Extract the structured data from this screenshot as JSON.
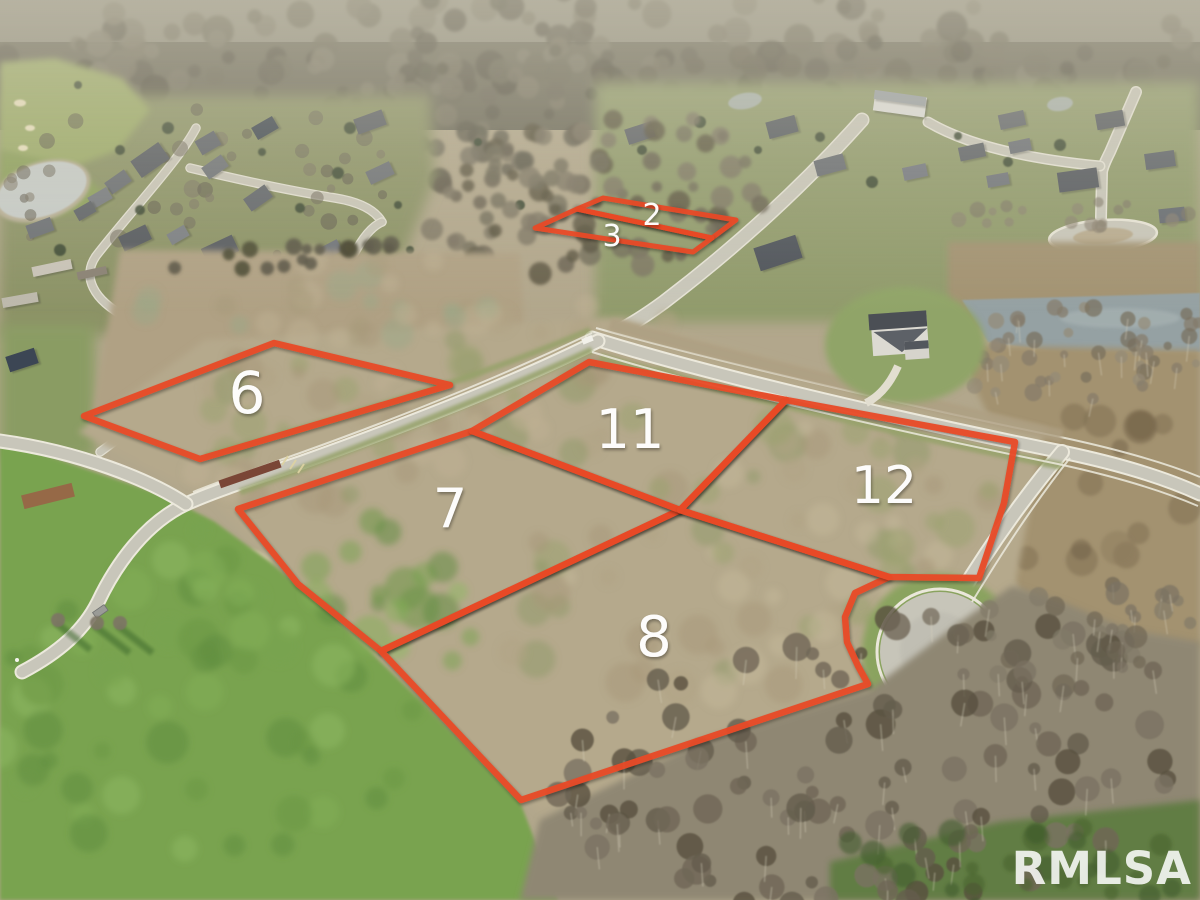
{
  "photo": {
    "description": "Aerial drone photo of a residential subdivision with vacant lots outlined",
    "width": 1200,
    "height": 900
  },
  "annotations": {
    "line_color": "#e84a28",
    "label_color": "#ffffff",
    "lots": [
      {
        "id": "2",
        "label": "2",
        "label_x": 652,
        "label_y": 225,
        "font_size": 30,
        "points": "577,209 603,198 736,220 712,238"
      },
      {
        "id": "3",
        "label": "3",
        "label_x": 612,
        "label_y": 246,
        "font_size": 30,
        "points": "535,228 577,209 712,238 693,252"
      },
      {
        "id": "6",
        "label": "6",
        "label_x": 247,
        "label_y": 413,
        "font_size": 58,
        "points": "84,416 274,343 450,385 200,459"
      },
      {
        "id": "7",
        "label": "7",
        "label_x": 450,
        "label_y": 527,
        "font_size": 54,
        "points": "472,431 680,510 381,651 298,584 238,509"
      },
      {
        "id": "8",
        "label": "8",
        "label_x": 654,
        "label_y": 656,
        "font_size": 56,
        "points": "680,510 889,577 855,593 845,617 847,642 858,666 868,684 521,800 381,651"
      },
      {
        "id": "11",
        "label": "11",
        "label_x": 630,
        "label_y": 448,
        "font_size": 54,
        "points": "472,431 589,362 786,400 680,510"
      },
      {
        "id": "12",
        "label": "12",
        "label_x": 884,
        "label_y": 503,
        "font_size": 52,
        "points": "786,400 1015,442 1004,503 979,578 889,577 680,510"
      }
    ]
  },
  "watermark": {
    "text": "RMLSA",
    "color": "rgba(255,255,255,0.85)"
  }
}
